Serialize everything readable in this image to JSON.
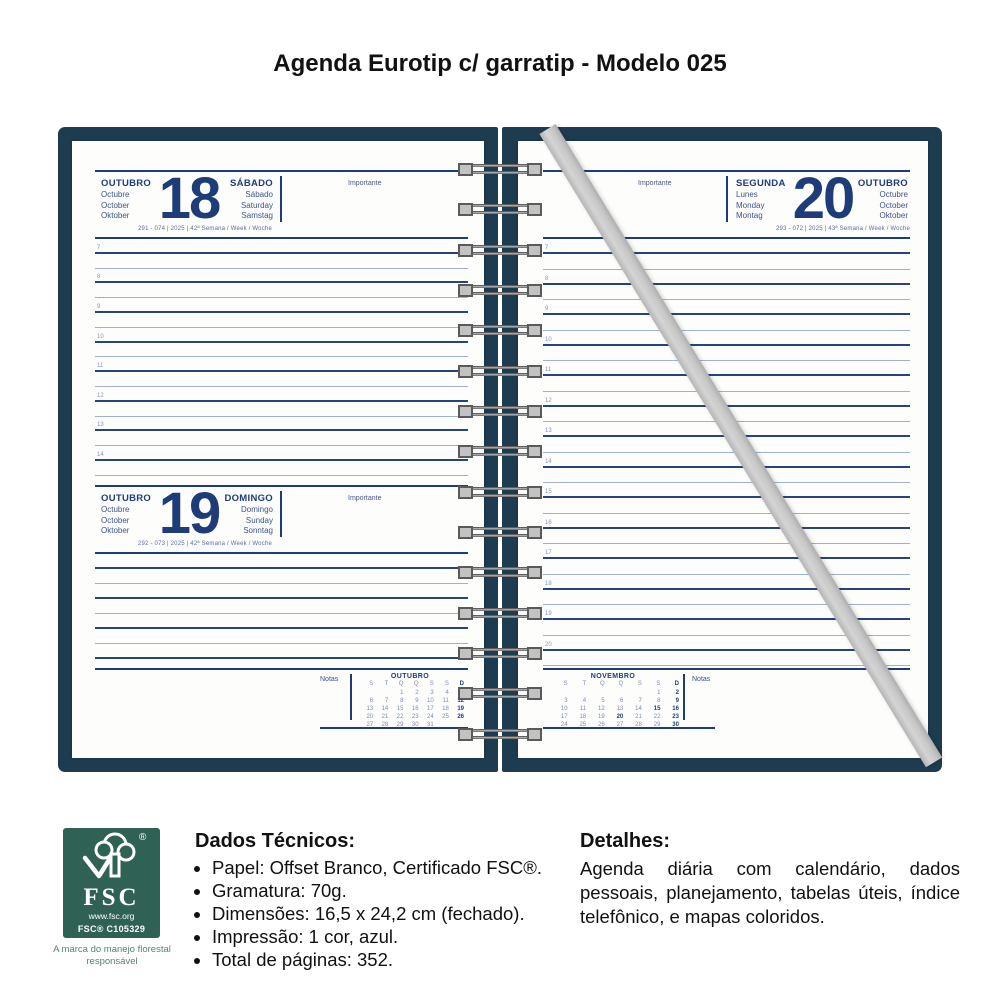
{
  "page_title": "Agenda Eurotip c/ garratip - Modelo 025",
  "colors": {
    "cover": "#1e3c50",
    "print_blue": "#1e3c78",
    "light_line": "#9fb0d2",
    "strap_gray": "#c8c8c8",
    "fsc_green": "#2f6255"
  },
  "agenda": {
    "rings": [
      "",
      "",
      "",
      "",
      "",
      "",
      "",
      "",
      "",
      "",
      "",
      "",
      "",
      "",
      ""
    ],
    "left_page": {
      "day18": {
        "month": {
          "main": "OUTUBRO",
          "alt1": "Octubre",
          "alt2": "October",
          "alt3": "Oktober"
        },
        "number": "18",
        "weekday": {
          "main": "SÁBADO",
          "alt1": "Sábado",
          "alt2": "Saturday",
          "alt3": "Samstag"
        },
        "importante": "Importante",
        "meta": "291 - 074 | 2025 | 42ª Semana / Week / Woche",
        "rows": [
          "7",
          "",
          "8",
          "",
          "9",
          "",
          "10",
          "",
          "11",
          "",
          "12",
          "",
          "13",
          "",
          "14",
          ""
        ]
      },
      "day19": {
        "month": {
          "main": "OUTUBRO",
          "alt1": "Octubre",
          "alt2": "October",
          "alt3": "Oktober"
        },
        "number": "19",
        "weekday": {
          "main": "DOMINGO",
          "alt1": "Domingo",
          "alt2": "Sunday",
          "alt3": "Sonntag"
        },
        "importante": "Importante",
        "meta": "292 - 073 | 2025 | 42ª Semana / Week / Woche",
        "rows": [
          "",
          "",
          "",
          "",
          "",
          "",
          ""
        ]
      },
      "notas": "Notas",
      "calendar": {
        "title": "OUTUBRO",
        "dow": [
          {
            "t": "S"
          },
          {
            "t": "T"
          },
          {
            "t": "Q"
          },
          {
            "t": "Q"
          },
          {
            "t": "S"
          },
          {
            "t": "S"
          },
          {
            "t": "D",
            "cls": "b"
          }
        ],
        "cells": [
          {
            "t": ""
          },
          {
            "t": ""
          },
          {
            "t": "1"
          },
          {
            "t": "2"
          },
          {
            "t": "3"
          },
          {
            "t": "4"
          },
          {
            "t": "5",
            "cls": "b"
          },
          {
            "t": "6"
          },
          {
            "t": "7"
          },
          {
            "t": "8"
          },
          {
            "t": "9"
          },
          {
            "t": "10"
          },
          {
            "t": "11"
          },
          {
            "t": "12",
            "cls": "b"
          },
          {
            "t": "13"
          },
          {
            "t": "14"
          },
          {
            "t": "15"
          },
          {
            "t": "16"
          },
          {
            "t": "17"
          },
          {
            "t": "18"
          },
          {
            "t": "19",
            "cls": "b"
          },
          {
            "t": "20"
          },
          {
            "t": "21"
          },
          {
            "t": "22"
          },
          {
            "t": "23"
          },
          {
            "t": "24"
          },
          {
            "t": "25"
          },
          {
            "t": "26",
            "cls": "b"
          },
          {
            "t": "27"
          },
          {
            "t": "28"
          },
          {
            "t": "29"
          },
          {
            "t": "30"
          },
          {
            "t": "31"
          },
          {
            "t": ""
          },
          {
            "t": ""
          }
        ]
      }
    },
    "right_page": {
      "day20": {
        "month": {
          "main": "OUTUBRO",
          "alt1": "Octubre",
          "alt2": "October",
          "alt3": "Oktober"
        },
        "number": "20",
        "weekday": {
          "main": "SEGUNDA",
          "alt1": "Lunes",
          "alt2": "Monday",
          "alt3": "Montag"
        },
        "importante": "Importante",
        "meta": "293 - 072 | 2025 | 43ª Semana / Week / Woche",
        "rows": [
          "7",
          "",
          "8",
          "",
          "9",
          "",
          "10",
          "",
          "11",
          "",
          "12",
          "",
          "13",
          "",
          "14",
          "",
          "15",
          "",
          "16",
          "",
          "17",
          "",
          "18",
          "",
          "19",
          "",
          "20",
          ""
        ]
      },
      "notas": "Notas",
      "calendar": {
        "title": "NOVEMBRO",
        "dow": [
          {
            "t": "S"
          },
          {
            "t": "T"
          },
          {
            "t": "Q"
          },
          {
            "t": "Q"
          },
          {
            "t": "S"
          },
          {
            "t": "S"
          },
          {
            "t": "D",
            "cls": "b"
          }
        ],
        "cells": [
          {
            "t": ""
          },
          {
            "t": ""
          },
          {
            "t": ""
          },
          {
            "t": ""
          },
          {
            "t": ""
          },
          {
            "t": "1"
          },
          {
            "t": "2",
            "cls": "b"
          },
          {
            "t": "3"
          },
          {
            "t": "4"
          },
          {
            "t": "5"
          },
          {
            "t": "6"
          },
          {
            "t": "7"
          },
          {
            "t": "8"
          },
          {
            "t": "9",
            "cls": "b"
          },
          {
            "t": "10"
          },
          {
            "t": "11"
          },
          {
            "t": "12"
          },
          {
            "t": "13"
          },
          {
            "t": "14"
          },
          {
            "t": "15",
            "cls": "b"
          },
          {
            "t": "16",
            "cls": "b"
          },
          {
            "t": "17"
          },
          {
            "t": "18"
          },
          {
            "t": "19"
          },
          {
            "t": "20",
            "cls": "b"
          },
          {
            "t": "21"
          },
          {
            "t": "22"
          },
          {
            "t": "23",
            "cls": "b"
          },
          {
            "t": "24"
          },
          {
            "t": "25"
          },
          {
            "t": "26"
          },
          {
            "t": "27"
          },
          {
            "t": "28"
          },
          {
            "t": "29"
          },
          {
            "t": "30",
            "cls": "b"
          }
        ]
      }
    }
  },
  "footer": {
    "fsc": {
      "brand": "FSC",
      "reg": "®",
      "url": "www.fsc.org",
      "cert": "FSC® C105329",
      "caption": "A marca do manejo florestal responsável"
    },
    "dados": {
      "heading": "Dados Técnicos:",
      "items": [
        "Papel: Offset Branco, Certificado FSC®.",
        "Gramatura: 70g.",
        "Dimensões: 16,5 x 24,2 cm (fechado).",
        "Impressão: 1 cor, azul.",
        "Total de páginas: 352."
      ]
    },
    "detalhes": {
      "heading": "Detalhes:",
      "text": "Agenda diária com calendário, dados pessoais, planejamento, tabelas úteis, índice telefônico, e mapas coloridos."
    }
  }
}
